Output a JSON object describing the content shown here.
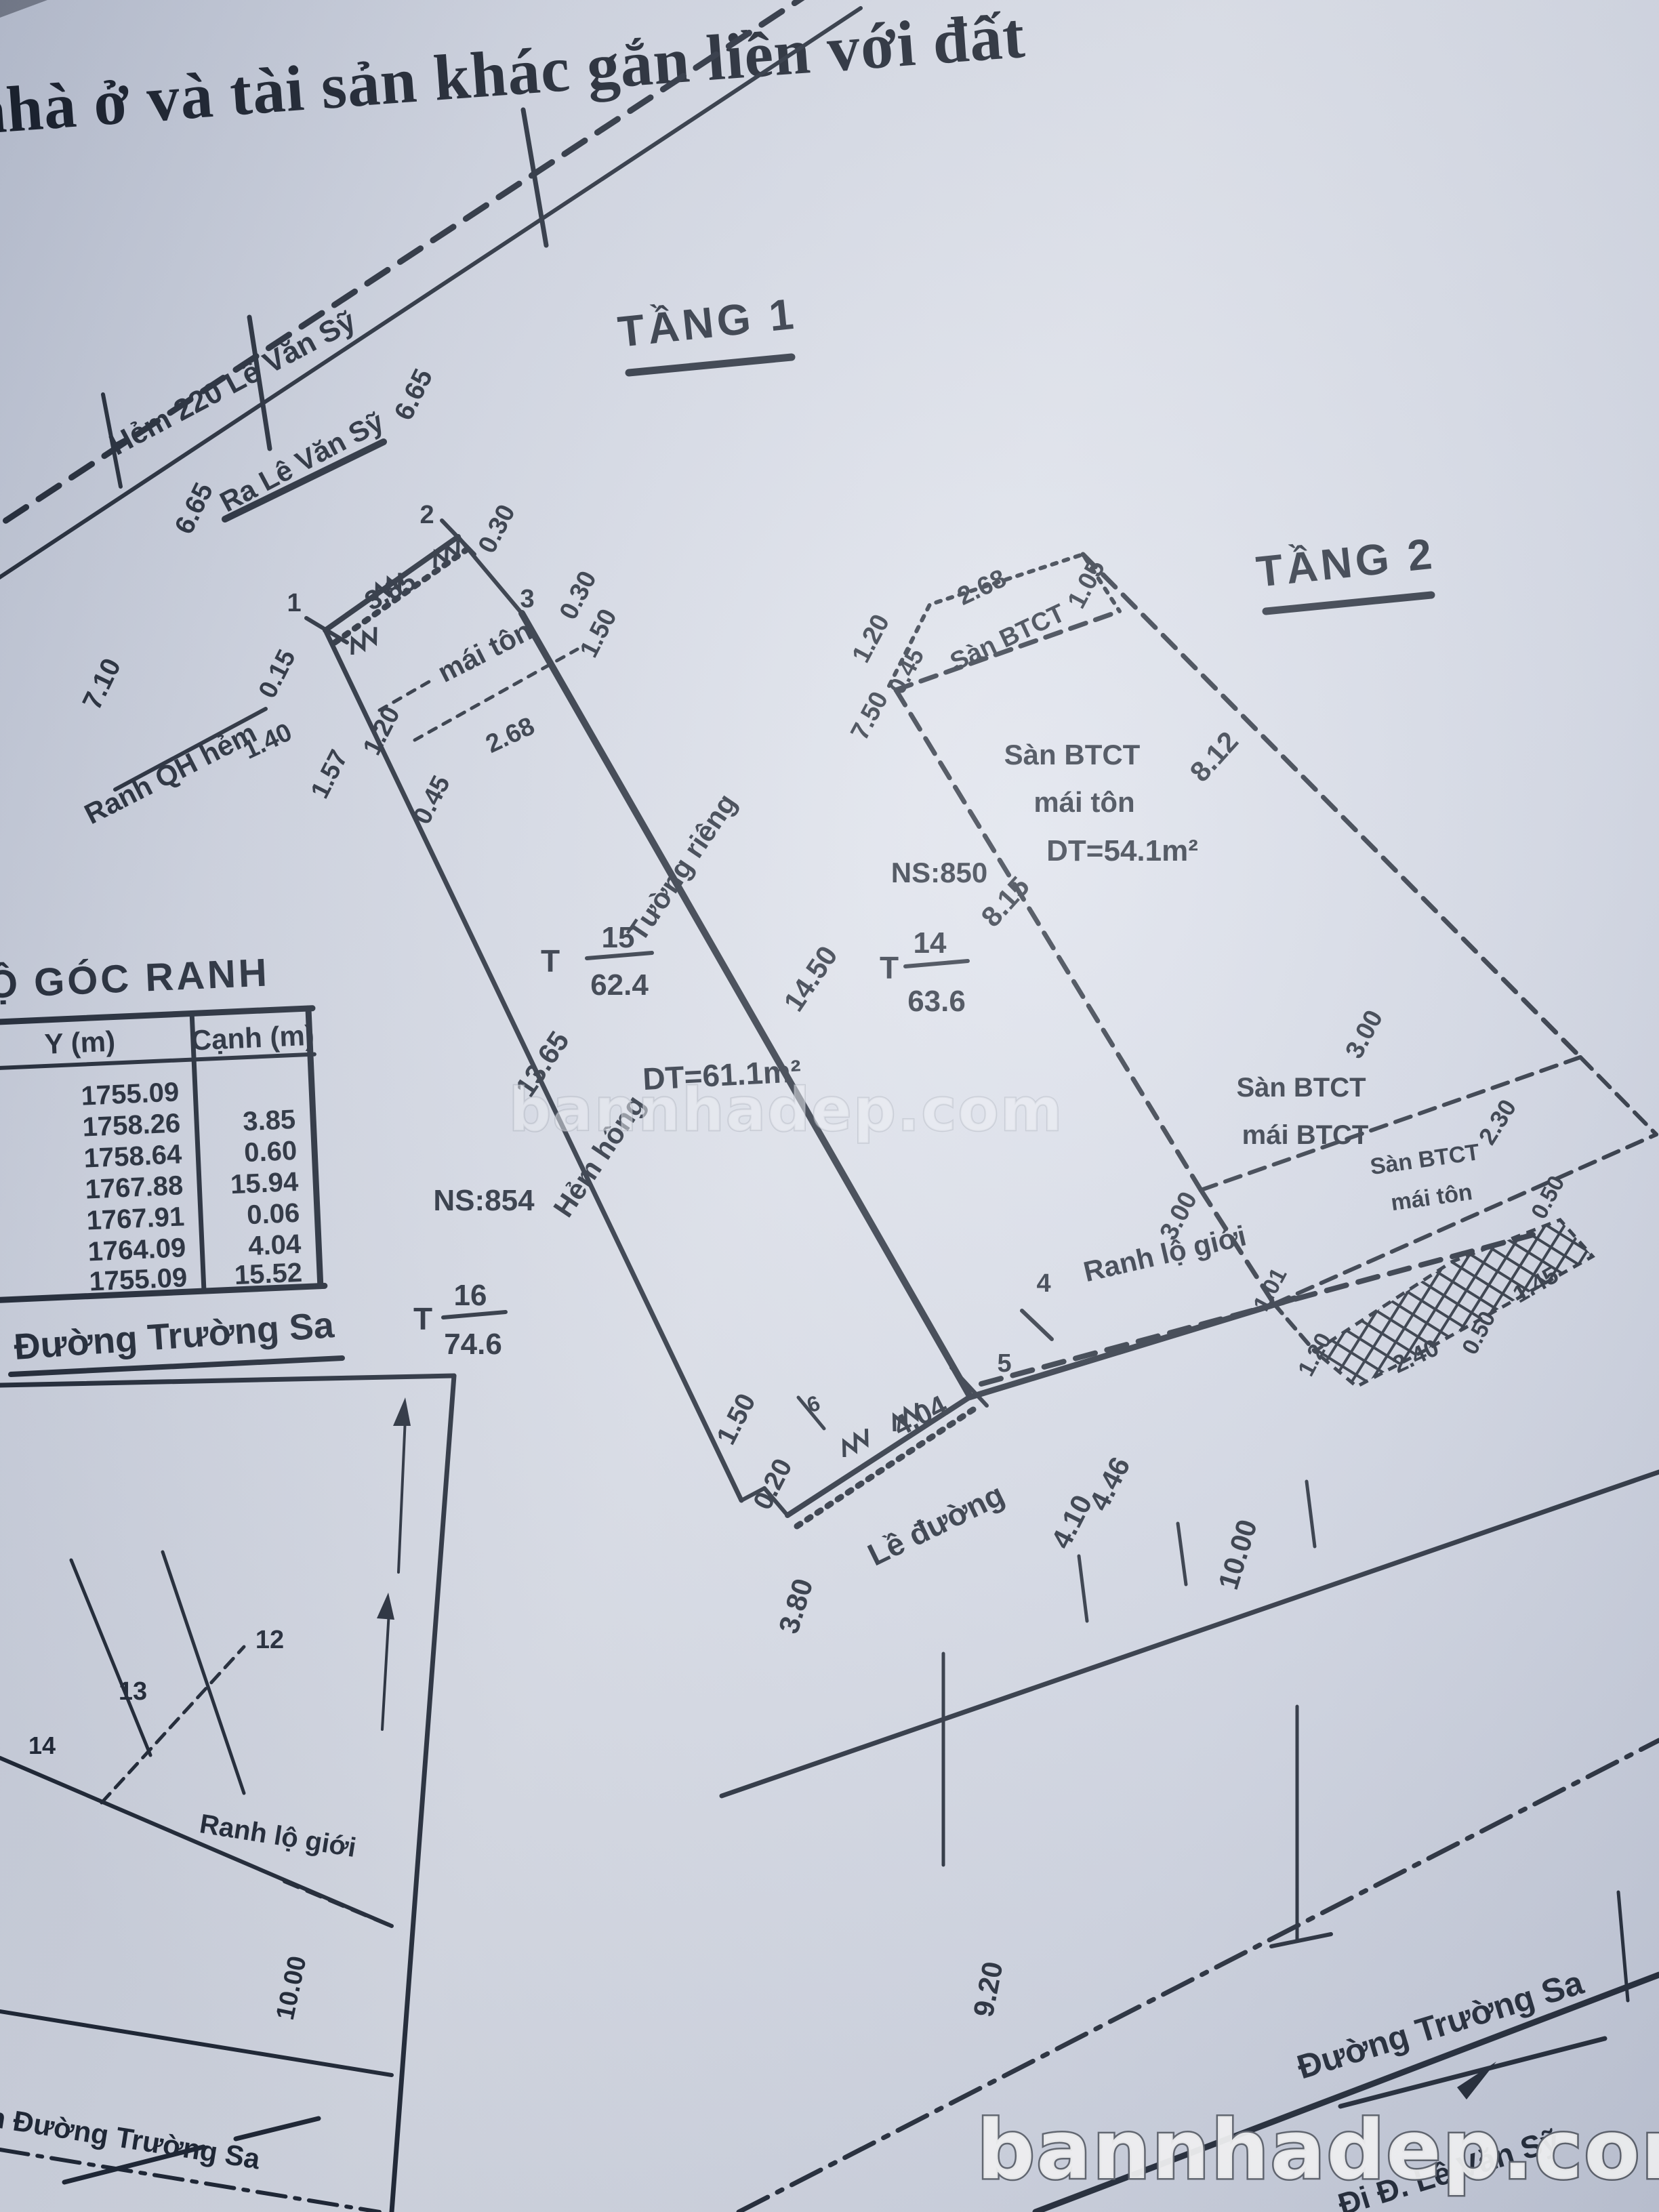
{
  "title": {
    "text": "nhà ở và tài sản khác gắn liền với đất"
  },
  "floor_labels": {
    "tang1": "TẦNG 1",
    "tang2": "TẦNG 2"
  },
  "alley": {
    "name": "Hẻm 220 Lê Văn Sỹ",
    "direction": "Ra Lê Văn Sỹ",
    "dims": [
      "6.65",
      "6.65",
      "7.10"
    ]
  },
  "floor1": {
    "vertices": [
      "1",
      "2",
      "3",
      "4",
      "5",
      "6"
    ],
    "top_dims": [
      "3.85",
      "0.30",
      "0.30",
      "1.50"
    ],
    "left_dims": [
      "0.15",
      "1.40",
      "1.57",
      "1.20",
      "2.68",
      "0.45"
    ],
    "roof": "mái tôn",
    "boundary_qh": "Ranh QH hẻm",
    "wall_right": "Tường riêng",
    "wall_right_len": "14.50",
    "wall_left_len": "13.65",
    "alley_side": "Hẻm hông",
    "area": "DT=61.1m²",
    "parcel": {
      "prefix": "T",
      "num": "15",
      "area": "62.4"
    },
    "neighbor": {
      "ns": "NS:854",
      "parcel": {
        "prefix": "T",
        "num": "16",
        "area": "74.6"
      }
    },
    "bottom_dims": [
      "1.50",
      "0.20",
      "3.80",
      "4.04"
    ],
    "boundary": "Ranh lộ giới",
    "sidewalk": {
      "label": "Lề đường",
      "dims": [
        "4.46",
        "4.10"
      ]
    }
  },
  "floor2": {
    "ns": "NS:850",
    "parcel": {
      "prefix": "T",
      "num": "14",
      "area": "63.6"
    },
    "top_dims": [
      "1.20",
      "0.45",
      "2.68",
      "1.05",
      "7.50"
    ],
    "top_label": "Sàn BTCT",
    "edge_left": "8.15",
    "edge_right": "8.12",
    "section1": [
      "Sàn BTCT",
      "mái tôn",
      "DT=54.1m²"
    ],
    "section2": [
      "Sàn BTCT",
      "mái BTCT"
    ],
    "section2_dims": [
      "3.00",
      "3.00"
    ],
    "section3": [
      "Sàn BTCT",
      "mái tôn"
    ],
    "section3_dims": [
      "2.30",
      "0.50",
      "1.45",
      "0.50",
      "2.40",
      "1.20",
      "1.01"
    ]
  },
  "table": {
    "title": "Ộ GÓC RANH",
    "col_y": "Y (m)",
    "col_canh": "Cạnh (m)",
    "y_values": [
      "1755.09",
      "1758.26",
      "1758.64",
      "1767.88",
      "1767.91",
      "1764.09",
      "1755.09"
    ],
    "canh_values": [
      "3.85",
      "0.60",
      "15.94",
      "0.06",
      "4.04",
      "15.52"
    ]
  },
  "mid_street": {
    "label": "Đường Trường Sa"
  },
  "inset": {
    "plots": [
      "12",
      "13",
      "14"
    ],
    "boundary": "Ranh lộ giới",
    "width": "10.00",
    "centerline": "m Đường Trường Sa"
  },
  "street": {
    "width": "10.00",
    "width2": "9.20",
    "name": "Đường Trường Sa",
    "direction": "Đi Đ. Lê Văn Sỹ"
  },
  "watermark": {
    "center": "bannhadep.com",
    "bottom": "bannhadep.com"
  }
}
